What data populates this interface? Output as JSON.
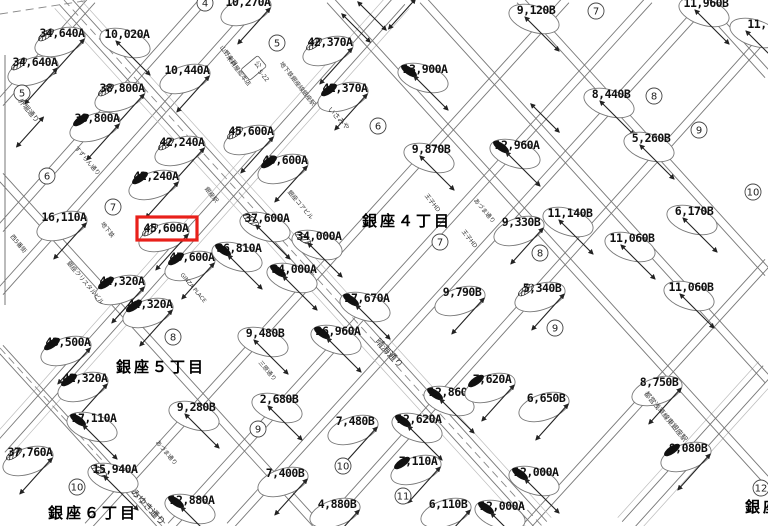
{
  "map": {
    "type": "rosenka-street-value-map",
    "background": "#ffffff",
    "line_color": "#777777",
    "light_line_color": "#bbbbbb",
    "text_color": "#111111",
    "highlight": {
      "x": 137,
      "y": 217,
      "w": 60,
      "h": 23,
      "color": "#e8201a",
      "label": "45,600A"
    },
    "value_labels": [
      {
        "t": "34,640A",
        "x": 62,
        "y": 33,
        "ang": -48,
        "leaf": "hatch"
      },
      {
        "t": "10,020A",
        "x": 127,
        "y": 34,
        "ang": 45,
        "leaf": null
      },
      {
        "t": "34,640A",
        "x": 35,
        "y": 62,
        "ang": -48,
        "leaf": "hatch"
      },
      {
        "t": "10,440A",
        "x": 187,
        "y": 70,
        "ang": -48,
        "leaf": null
      },
      {
        "t": "38,800A",
        "x": 122,
        "y": 88,
        "ang": -48,
        "leaf": "hatch"
      },
      {
        "t": "38,800A",
        "x": 97,
        "y": 118,
        "ang": -48,
        "leaf": "black"
      },
      {
        "t": "42,240A",
        "x": 182,
        "y": 142,
        "ang": -48,
        "leaf": "hatch"
      },
      {
        "t": "42,240A",
        "x": 156,
        "y": 176,
        "ang": -48,
        "leaf": "black"
      },
      {
        "t": "16,110A",
        "x": 64,
        "y": 217,
        "ang": -48,
        "leaf": null
      },
      {
        "t": "45,600A",
        "x": 166,
        "y": 228,
        "ang": -48,
        "leaf": "hatch",
        "highlight": true
      },
      {
        "t": "45,600A",
        "x": 192,
        "y": 257,
        "ang": -48,
        "leaf": "black"
      },
      {
        "t": "45,600A",
        "x": 251,
        "y": 131,
        "ang": -48,
        "leaf": "hatch"
      },
      {
        "t": "45,600A",
        "x": 285,
        "y": 160,
        "ang": -48,
        "leaf": "black"
      },
      {
        "t": "42,370A",
        "x": 330,
        "y": 42,
        "ang": -48,
        "leaf": "hatch"
      },
      {
        "t": "42,370A",
        "x": 345,
        "y": 88,
        "ang": -48,
        "leaf": "black"
      },
      {
        "t": "13,900A",
        "x": 425,
        "y": 69,
        "ang": 45,
        "leaf": "black"
      },
      {
        "t": "10,270A",
        "x": 248,
        "y": 2,
        "ang": -48,
        "leaf": null
      },
      {
        "t": "9,120B",
        "x": 536,
        "y": 10,
        "ang": 45,
        "leaf": null
      },
      {
        "t": "11,960B",
        "x": 706,
        "y": 3,
        "ang": 45,
        "leaf": null
      },
      {
        "t": "8,440B",
        "x": 611,
        "y": 94,
        "ang": 45,
        "leaf": null
      },
      {
        "t": "5,260B",
        "x": 651,
        "y": 138,
        "ang": 45,
        "leaf": null
      },
      {
        "t": "12,960A",
        "x": 517,
        "y": 145,
        "ang": 45,
        "leaf": "black"
      },
      {
        "t": "9,870B",
        "x": 431,
        "y": 149,
        "ang": 45,
        "leaf": null
      },
      {
        "t": "11,",
        "x": 757,
        "y": 24,
        "ang": 45,
        "leaf": null
      },
      {
        "t": "37,600A",
        "x": 267,
        "y": 218,
        "ang": 45,
        "leaf": "hatch"
      },
      {
        "t": "34,000A",
        "x": 319,
        "y": 236,
        "ang": 45,
        "leaf": "hatch"
      },
      {
        "t": "36,810A",
        "x": 239,
        "y": 248,
        "ang": 45,
        "leaf": "black"
      },
      {
        "t": "34,000A",
        "x": 294,
        "y": 269,
        "ang": 45,
        "leaf": "black"
      },
      {
        "t": "27,670A",
        "x": 367,
        "y": 298,
        "ang": 45,
        "leaf": "black"
      },
      {
        "t": "9,330B",
        "x": 521,
        "y": 222,
        "ang": -48,
        "leaf": null
      },
      {
        "t": "11,140B",
        "x": 570,
        "y": 213,
        "ang": 45,
        "leaf": null
      },
      {
        "t": "6,170B",
        "x": 694,
        "y": 211,
        "ang": 45,
        "leaf": null
      },
      {
        "t": "11,060B",
        "x": 632,
        "y": 238,
        "ang": 45,
        "leaf": null
      },
      {
        "t": "11,060B",
        "x": 691,
        "y": 287,
        "ang": 45,
        "leaf": null
      },
      {
        "t": "5,340B",
        "x": 542,
        "y": 288,
        "ang": -48,
        "leaf": "hatch"
      },
      {
        "t": "9,790B",
        "x": 462,
        "y": 292,
        "ang": -48,
        "leaf": null
      },
      {
        "t": "44,320A",
        "x": 122,
        "y": 281,
        "ang": -48,
        "leaf": "black"
      },
      {
        "t": "44,320A",
        "x": 150,
        "y": 304,
        "ang": -48,
        "leaf": "black"
      },
      {
        "t": "43,500A",
        "x": 68,
        "y": 342,
        "ang": -48,
        "leaf": "black"
      },
      {
        "t": "42,320A",
        "x": 85,
        "y": 378,
        "ang": -48,
        "leaf": "black"
      },
      {
        "t": "9,480B",
        "x": 265,
        "y": 333,
        "ang": 45,
        "leaf": null
      },
      {
        "t": "26,960A",
        "x": 338,
        "y": 331,
        "ang": 45,
        "leaf": "black"
      },
      {
        "t": "17,110A",
        "x": 94,
        "y": 418,
        "ang": 45,
        "leaf": "black"
      },
      {
        "t": "37,760A",
        "x": 30,
        "y": 452,
        "ang": -48,
        "leaf": "hatch"
      },
      {
        "t": "15,940A",
        "x": 115,
        "y": 469,
        "ang": 45,
        "leaf": "hatch"
      },
      {
        "t": "12,880A",
        "x": 192,
        "y": 500,
        "ang": 45,
        "leaf": "black"
      },
      {
        "t": "9,280B",
        "x": 196,
        "y": 407,
        "ang": 45,
        "leaf": null
      },
      {
        "t": "2,680B",
        "x": 279,
        "y": 399,
        "ang": 45,
        "leaf": null
      },
      {
        "t": "7,480B",
        "x": 355,
        "y": 421,
        "ang": -48,
        "leaf": null
      },
      {
        "t": "7,400B",
        "x": 285,
        "y": 473,
        "ang": -48,
        "leaf": null
      },
      {
        "t": "4,880B",
        "x": 337,
        "y": 504,
        "ang": -48,
        "leaf": null
      },
      {
        "t": "12,860A",
        "x": 451,
        "y": 392,
        "ang": 45,
        "leaf": "black"
      },
      {
        "t": "12,620A",
        "x": 419,
        "y": 419,
        "ang": 45,
        "leaf": "black"
      },
      {
        "t": "7,110A",
        "x": 418,
        "y": 461,
        "ang": -48,
        "leaf": "black"
      },
      {
        "t": "6,110B",
        "x": 448,
        "y": 504,
        "ang": -48,
        "leaf": null
      },
      {
        "t": "7,620A",
        "x": 492,
        "y": 379,
        "ang": -48,
        "leaf": "black"
      },
      {
        "t": "6,650B",
        "x": 546,
        "y": 398,
        "ang": -48,
        "leaf": null
      },
      {
        "t": "8,750B",
        "x": 659,
        "y": 382,
        "ang": -48,
        "leaf": null
      },
      {
        "t": "12,000A",
        "x": 536,
        "y": 472,
        "ang": 45,
        "leaf": "black"
      },
      {
        "t": "12,000A",
        "x": 502,
        "y": 506,
        "ang": 45,
        "leaf": "black"
      },
      {
        "t": "8,080B",
        "x": 688,
        "y": 448,
        "ang": -48,
        "leaf": "black"
      }
    ],
    "circled_numbers": [
      {
        "n": "4",
        "x": 205,
        "y": 3
      },
      {
        "n": "5",
        "x": 22,
        "y": 93
      },
      {
        "n": "5",
        "x": 277,
        "y": 43
      },
      {
        "n": "6",
        "x": 47,
        "y": 176
      },
      {
        "n": "6",
        "x": 378,
        "y": 126
      },
      {
        "n": "7",
        "x": 113,
        "y": 207
      },
      {
        "n": "7",
        "x": 440,
        "y": 242
      },
      {
        "n": "7",
        "x": 596,
        "y": 11
      },
      {
        "n": "8",
        "x": 173,
        "y": 337
      },
      {
        "n": "8",
        "x": 540,
        "y": 253
      },
      {
        "n": "8",
        "x": 654,
        "y": 96
      },
      {
        "n": "9",
        "x": 258,
        "y": 429
      },
      {
        "n": "9",
        "x": 555,
        "y": 328
      },
      {
        "n": "9",
        "x": 699,
        "y": 130
      },
      {
        "n": "10",
        "x": 77,
        "y": 487
      },
      {
        "n": "10",
        "x": 343,
        "y": 466
      },
      {
        "n": "10",
        "x": 753,
        "y": 192
      },
      {
        "n": "11",
        "x": 403,
        "y": 496
      },
      {
        "n": "12",
        "x": 761,
        "y": 488
      }
    ],
    "district_labels": [
      {
        "t": "銀座４丁目",
        "x": 407,
        "y": 220
      },
      {
        "t": "銀座５丁目",
        "x": 161,
        "y": 366
      },
      {
        "t": "銀座６丁目",
        "x": 93,
        "y": 512
      },
      {
        "t": "銀座",
        "x": 763,
        "y": 506
      }
    ],
    "street_texts": [
      {
        "t": "晴海通り",
        "x": 387,
        "y": 355,
        "ang": 47,
        "s": 9
      },
      {
        "t": "みゆき通り",
        "x": 146,
        "y": 509,
        "ang": 47,
        "s": 9
      },
      {
        "t": "外堀通り",
        "x": 27,
        "y": 112,
        "ang": 50,
        "s": 7
      },
      {
        "t": "西5番街",
        "x": 17,
        "y": 245,
        "ang": 50,
        "s": 6
      },
      {
        "t": "すずらん通り",
        "x": 86,
        "y": 162,
        "ang": 50,
        "s": 6
      },
      {
        "t": "三原通り",
        "x": 266,
        "y": 372,
        "ang": 50,
        "s": 6
      },
      {
        "t": "あづま通り",
        "x": 483,
        "y": 212,
        "ang": 50,
        "s": 6
      },
      {
        "t": "あづま通り",
        "x": 165,
        "y": 454,
        "ang": 50,
        "s": 6
      },
      {
        "t": "山野楽器",
        "x": 227,
        "y": 57,
        "ang": 52,
        "s": 6
      },
      {
        "t": "木村屋総本店",
        "x": 237,
        "y": 72,
        "ang": 52,
        "s": 6
      },
      {
        "t": "地下鉄銀座線銀座駅",
        "x": 296,
        "y": 85,
        "ang": 52,
        "s": 6
      },
      {
        "t": "銀座駅",
        "x": 210,
        "y": 196,
        "ang": 52,
        "s": 6
      },
      {
        "t": "地下鉄",
        "x": 106,
        "y": 231,
        "ang": 52,
        "s": 6
      },
      {
        "t": "いさみや",
        "x": 337,
        "y": 120,
        "ang": 47,
        "s": 7
      },
      {
        "t": "王子HD",
        "x": 431,
        "y": 204,
        "ang": 52,
        "s": 6
      },
      {
        "t": "王子HD",
        "x": 468,
        "y": 240,
        "ang": 52,
        "s": 6
      },
      {
        "t": "都営浅草線東銀座駅",
        "x": 664,
        "y": 418,
        "ang": 50,
        "s": 7
      },
      {
        "t": "GINZA PLACE",
        "x": 192,
        "y": 289,
        "ang": 50,
        "s": 5.5
      },
      {
        "t": "銀座クリスタルビル",
        "x": 84,
        "y": 284,
        "ang": 50,
        "s": 6
      },
      {
        "t": "銀座コアビル",
        "x": 299,
        "y": 206,
        "ang": 50,
        "s": 6
      },
      {
        "t": "公",
        "x": 256,
        "y": 66,
        "ang": 50,
        "s": 7,
        "boxed": true
      },
      {
        "t": "5-22",
        "x": 262,
        "y": 77,
        "ang": 50,
        "s": 6
      }
    ],
    "streets": [
      {
        "x1": 92,
        "y1": 0,
        "x2": 0,
        "y2": 103,
        "major": false
      },
      {
        "x1": 204,
        "y1": 0,
        "x2": 0,
        "y2": 229,
        "major": false
      },
      {
        "x1": 261,
        "y1": 0,
        "x2": 0,
        "y2": 292,
        "major": false
      },
      {
        "x1": 400,
        "y1": 0,
        "x2": 0,
        "y2": 448,
        "major": true
      },
      {
        "x1": 566,
        "y1": 0,
        "x2": 88,
        "y2": 526,
        "major": false
      },
      {
        "x1": 649,
        "y1": 0,
        "x2": 171,
        "y2": 526,
        "major": false
      },
      {
        "x1": 708,
        "y1": 0,
        "x2": 230,
        "y2": 526,
        "major": false
      },
      {
        "x1": 768,
        "y1": 33,
        "x2": 325,
        "y2": 526,
        "major": false
      },
      {
        "x1": 768,
        "y1": 262,
        "x2": 527,
        "y2": 526,
        "major": false
      },
      {
        "x1": 768,
        "y1": 370,
        "x2": 627,
        "y2": 526,
        "major": true
      },
      {
        "x1": 64,
        "y1": 0,
        "x2": 542,
        "y2": 526,
        "major": true
      },
      {
        "x1": 0,
        "y1": 348,
        "x2": 162,
        "y2": 526,
        "major": false
      },
      {
        "x1": 0,
        "y1": 176,
        "x2": 318,
        "y2": 526,
        "major": false
      },
      {
        "x1": 330,
        "y1": 0,
        "x2": 768,
        "y2": 482,
        "major": false
      },
      {
        "x1": 423,
        "y1": 0,
        "x2": 768,
        "y2": 380,
        "major": false
      },
      {
        "x1": 520,
        "y1": 0,
        "x2": 768,
        "y2": 273,
        "major": false
      },
      {
        "x1": 700,
        "y1": 0,
        "x2": 768,
        "y2": 75,
        "major": false
      }
    ],
    "dashed_lines": [
      {
        "x1": 64,
        "y1": 0,
        "x2": 542,
        "y2": 526
      },
      {
        "x1": 0,
        "y1": 348,
        "x2": 162,
        "y2": 526
      },
      {
        "x1": 0,
        "y1": 14,
        "x2": 90,
        "y2": 0
      }
    ],
    "extra_lines": [
      {
        "x1": 5,
        "y1": 55,
        "x2": 5,
        "y2": 305
      }
    ],
    "extra_arrows": [
      {
        "x": 372,
        "y": 16,
        "ang": 45
      },
      {
        "x": 402,
        "y": 14,
        "ang": -48
      },
      {
        "x": 356,
        "y": 28,
        "ang": 45
      },
      {
        "x": 30,
        "y": 132,
        "ang": -48
      },
      {
        "x": 545,
        "y": 118,
        "ang": 45
      }
    ]
  }
}
